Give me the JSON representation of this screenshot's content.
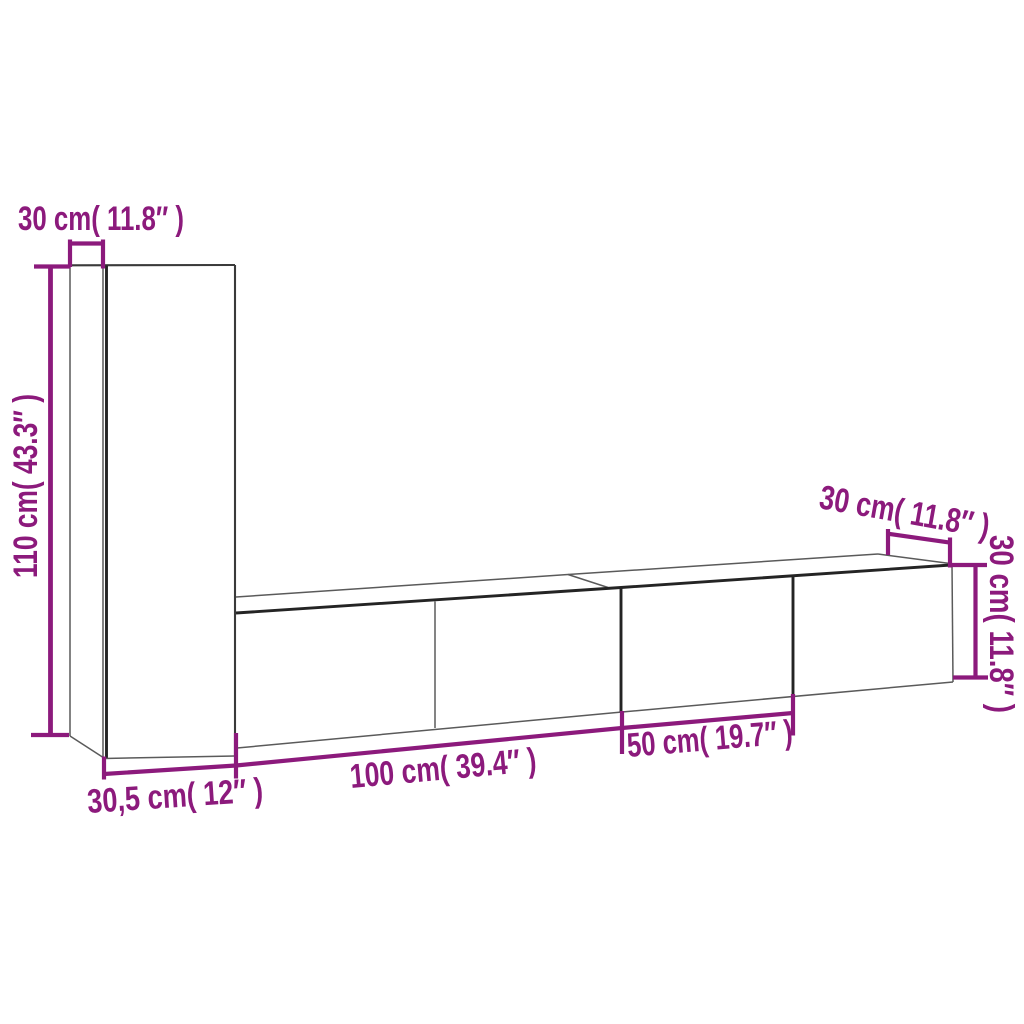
{
  "figure": {
    "type": "furniture-dimension-diagram",
    "subject": "3-piece wall-mounted TV cabinet set, outline drawing with dimension lines"
  },
  "colors": {
    "dimension_accent": "#8C1A7C",
    "outline_dark": "#242424",
    "outline_light": "#5a5a5a",
    "background": "#ffffff"
  },
  "labels": {
    "tall_cabinet_depth_top": "30 cm( 11.8″ )",
    "tall_cabinet_height_left": "110 cm( 43.3″ )",
    "tall_cabinet_width_bottom": "30,5 cm( 12″ )",
    "long_cabinet_width_bottom": "100 cm( 39.4″ )",
    "small_cabinet_width_bottom": "50 cm( 19.7″ )",
    "right_cabinet_depth_top": "30 cm( 11.8″ )",
    "right_cabinet_height_right": "30 cm( 11.8″ )"
  }
}
